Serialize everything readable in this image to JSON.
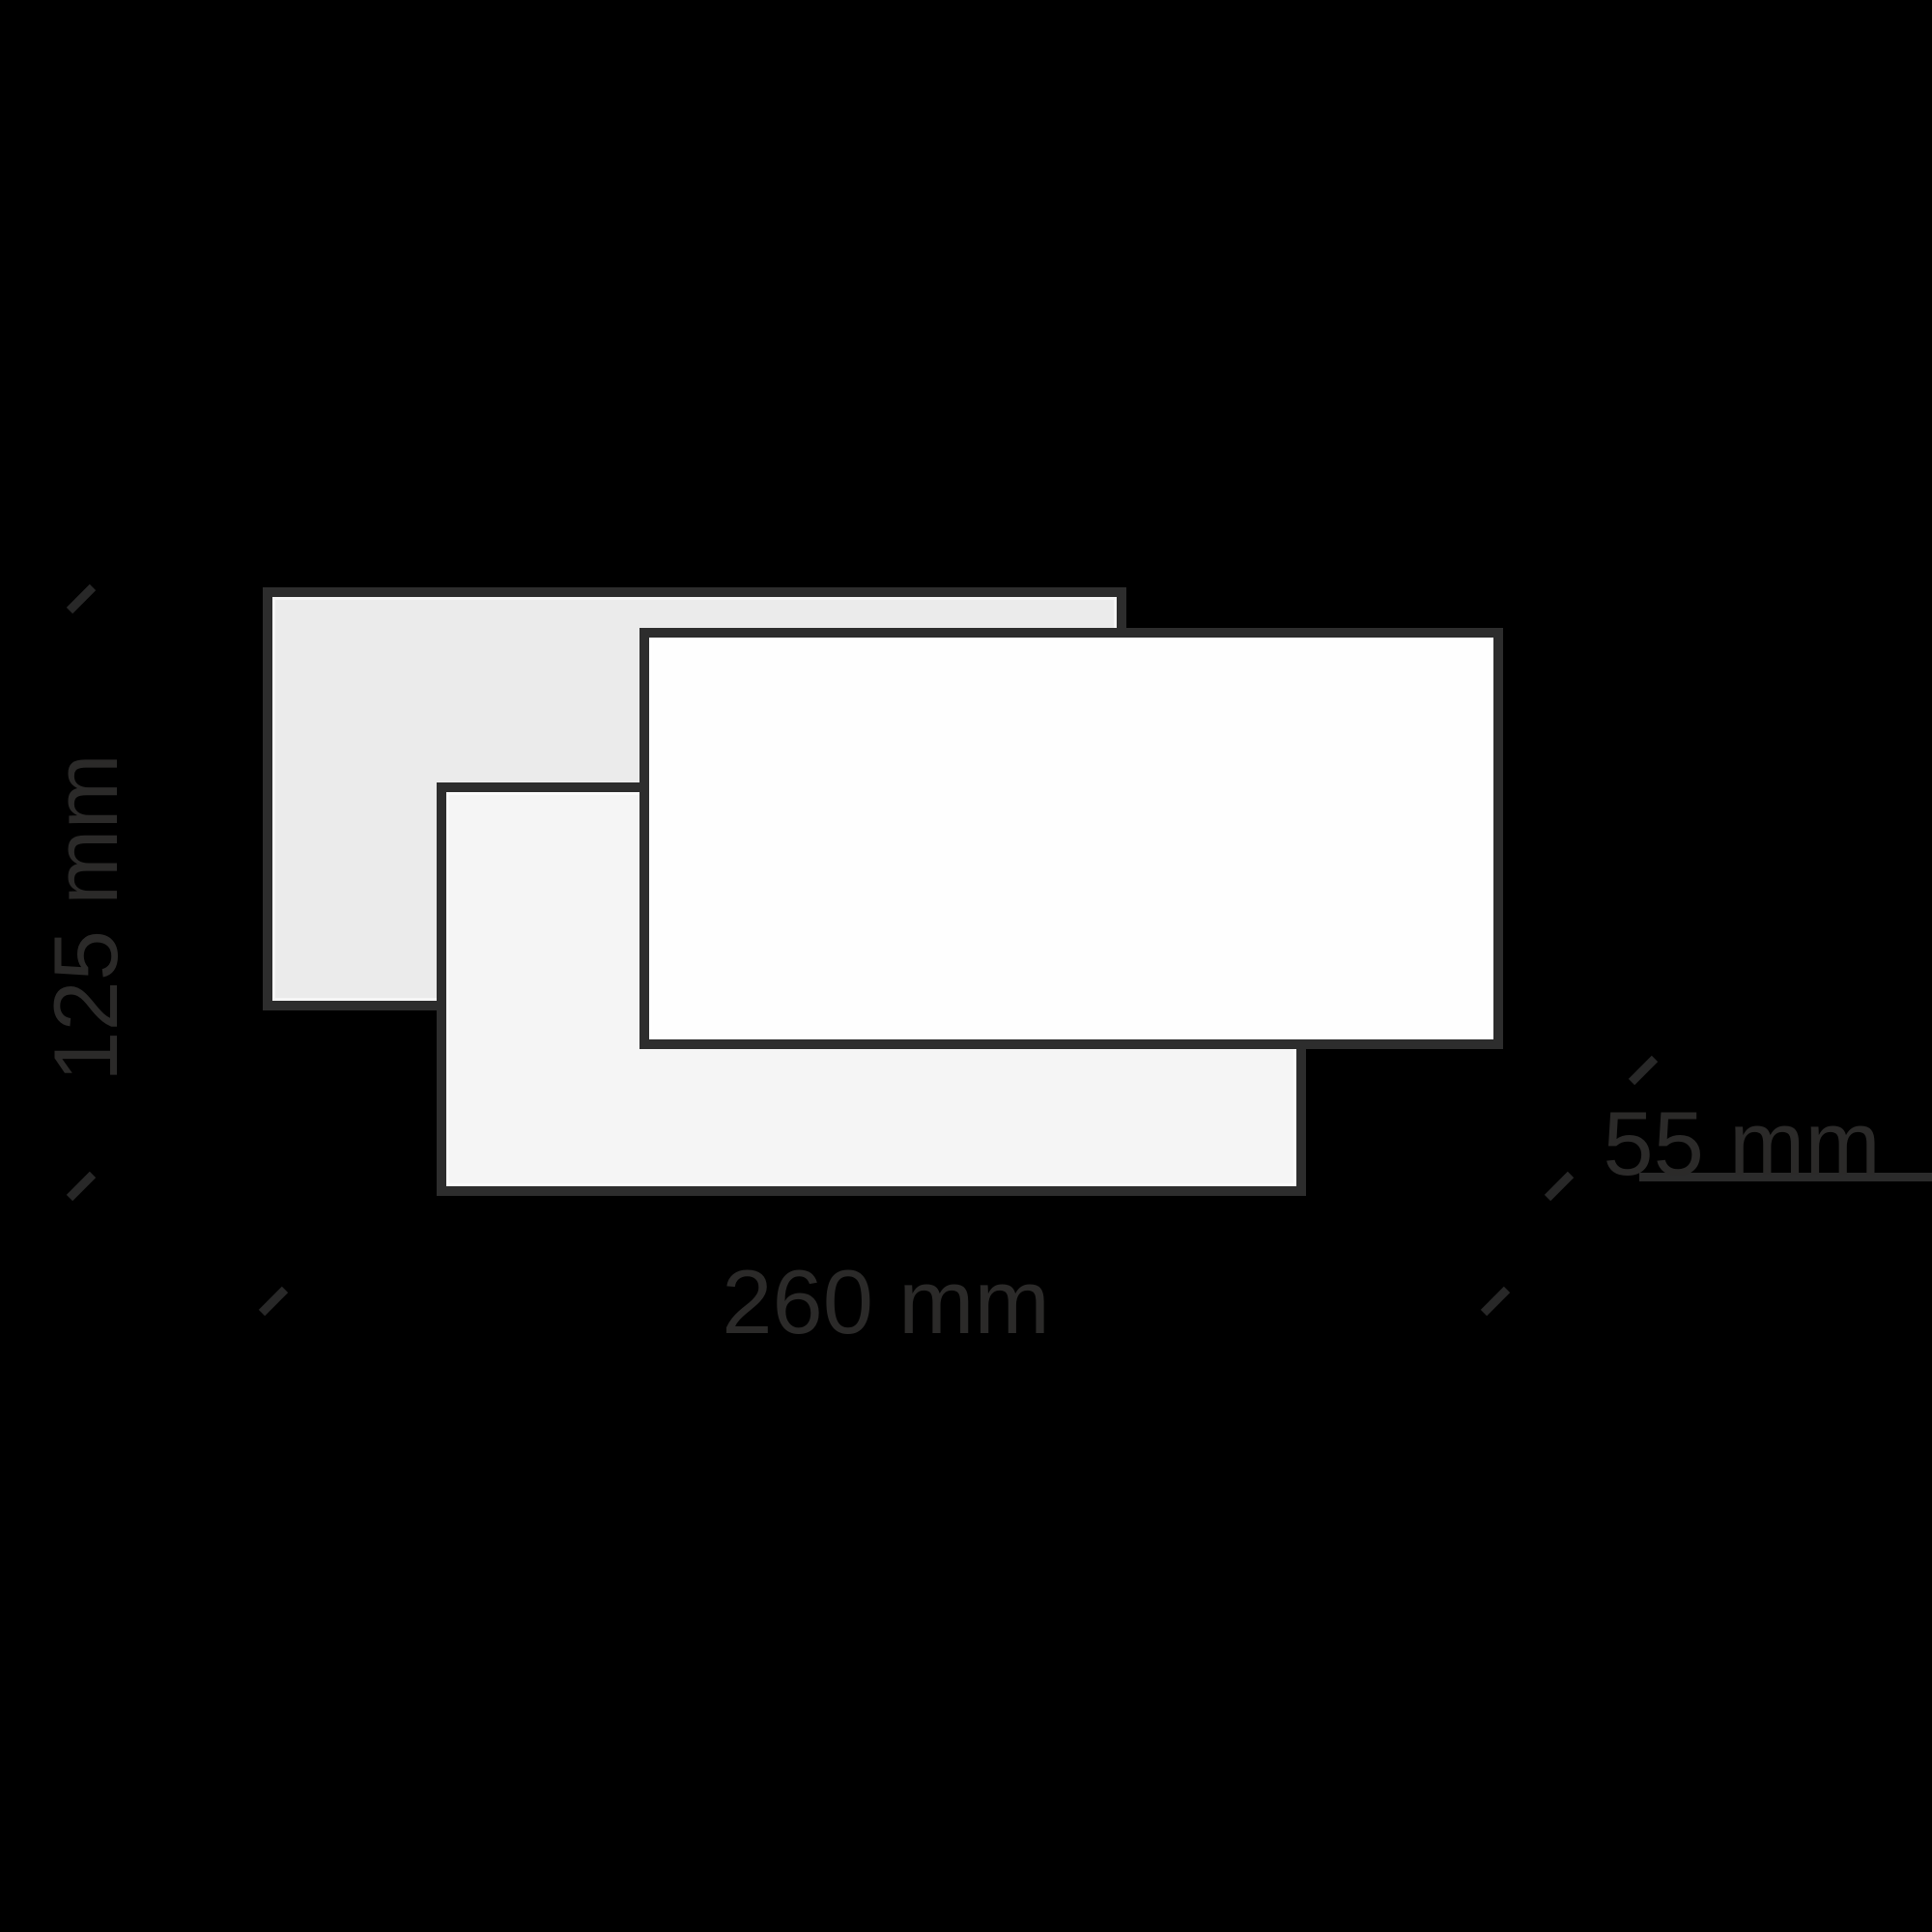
{
  "diagram": {
    "type": "product-dimension-drawing",
    "background_color": "#000000",
    "panel_border_color": "#2d2d2d",
    "annotation_color": "#2b2a29",
    "panels": [
      {
        "name": "back-panel",
        "fill": "#ebebeb"
      },
      {
        "name": "lower-panel",
        "fill": "#f5f5f5"
      },
      {
        "name": "front-panel",
        "fill": "#fefefe"
      }
    ],
    "dimensions": {
      "height_label": "125 mm",
      "width_label": "260 mm",
      "depth_label": "55 mm"
    }
  }
}
